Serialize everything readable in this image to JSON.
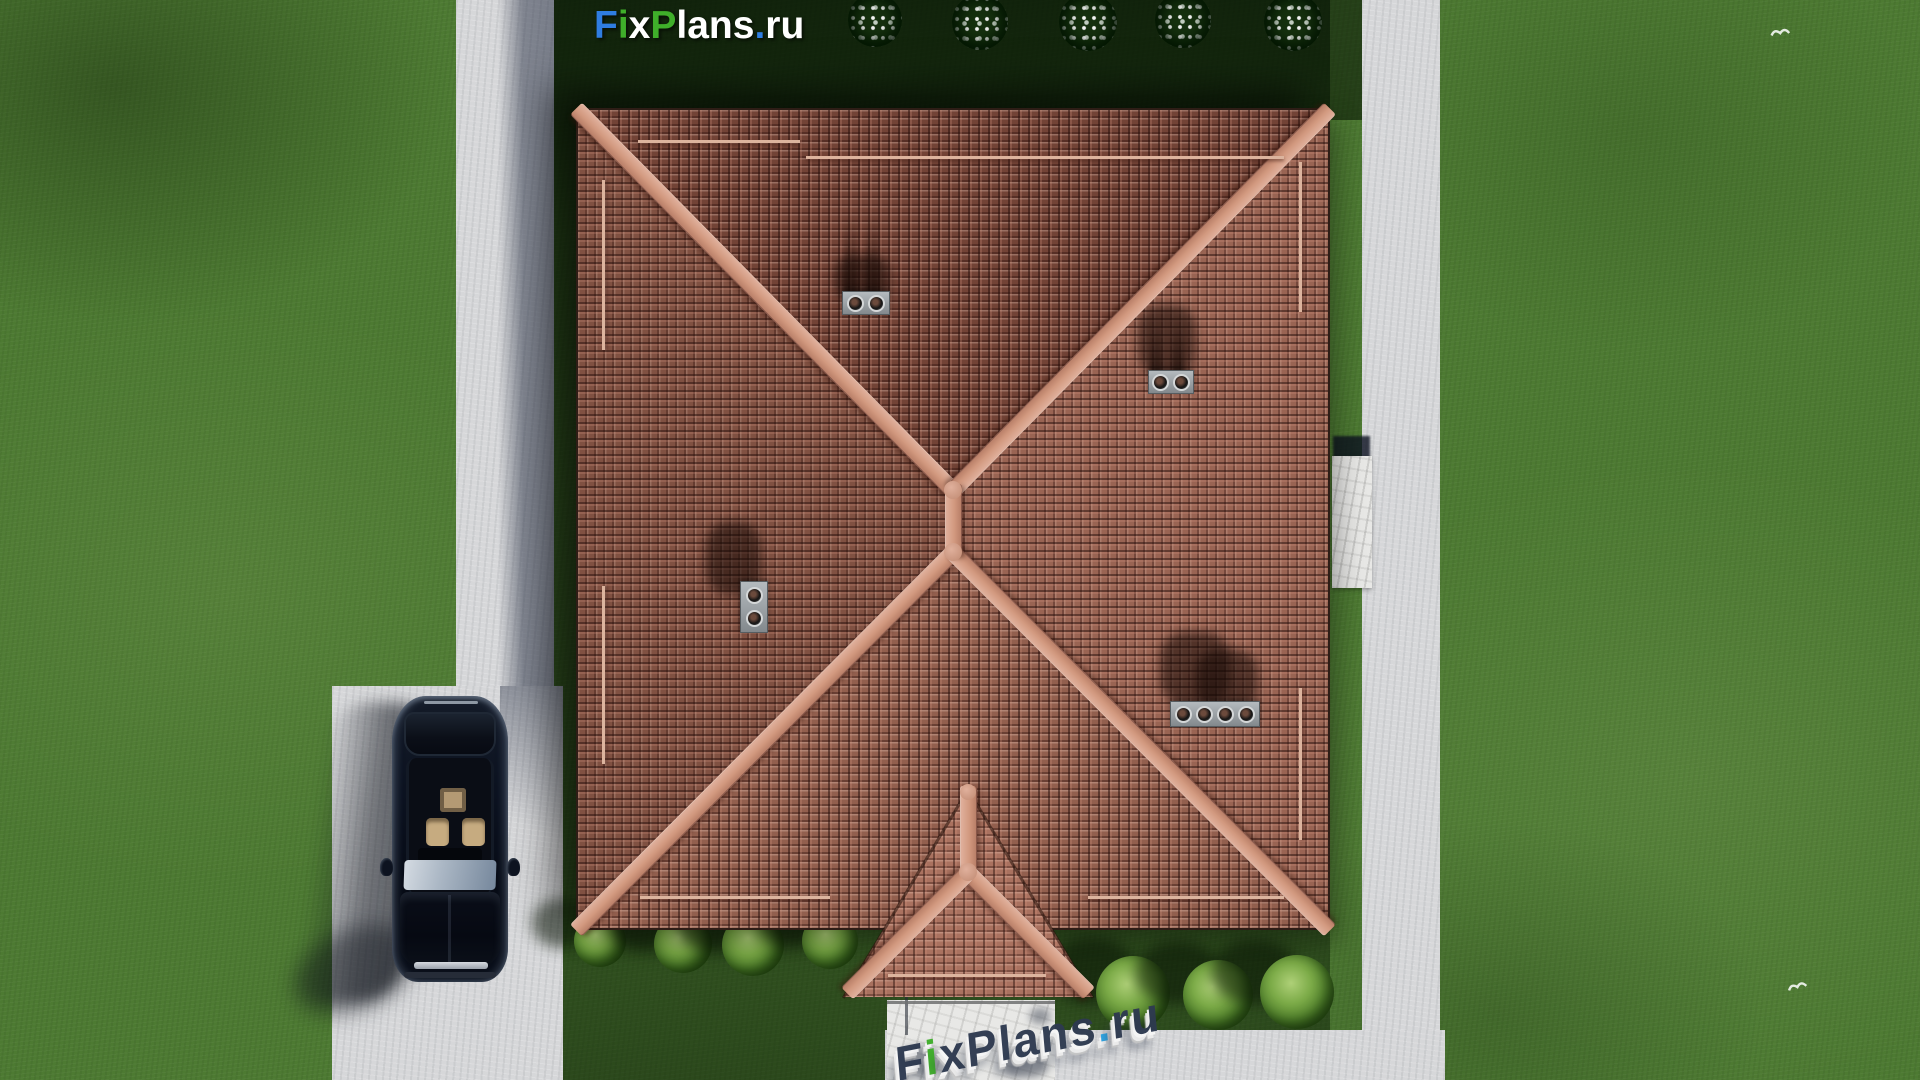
{
  "brand": {
    "name": "FixPlans.ru",
    "segments": [
      {
        "text": "F",
        "color": "#2f7de1"
      },
      {
        "text": "i",
        "color": "#3fae2a"
      },
      {
        "text": "x",
        "color": "#ffffff"
      },
      {
        "text": "P",
        "color": "#3fae2a"
      },
      {
        "text": "lans",
        "color": "#ffffff"
      },
      {
        "text": ".",
        "color": "#2f7de1"
      },
      {
        "text": "ru",
        "color": "#ffffff"
      }
    ]
  },
  "watermark": {
    "text": "FixPlans.ru",
    "segments": [
      {
        "text": "F",
        "color": "#2e3a50"
      },
      {
        "text": "i",
        "color": "#3fae2a"
      },
      {
        "text": "x",
        "color": "#2e3a50"
      },
      {
        "text": "P",
        "color": "#2e3a50"
      },
      {
        "text": "lans",
        "color": "#2e3a50"
      },
      {
        "text": ".",
        "color": "#2aa7e8"
      },
      {
        "text": "ru",
        "color": "#2e3a50"
      }
    ]
  },
  "palette": {
    "lawn-base": "#4d7a32",
    "path-light": "#d6d7d9",
    "roof-base": "#a8705f",
    "roof-ridge": "#d2997f",
    "chimney-grey": "#9aa0a4",
    "bush-green": "#7cab48",
    "stone-white": "#e8e8e6",
    "car-body": "#141b28",
    "car-interior": "#c6ab80"
  }
}
